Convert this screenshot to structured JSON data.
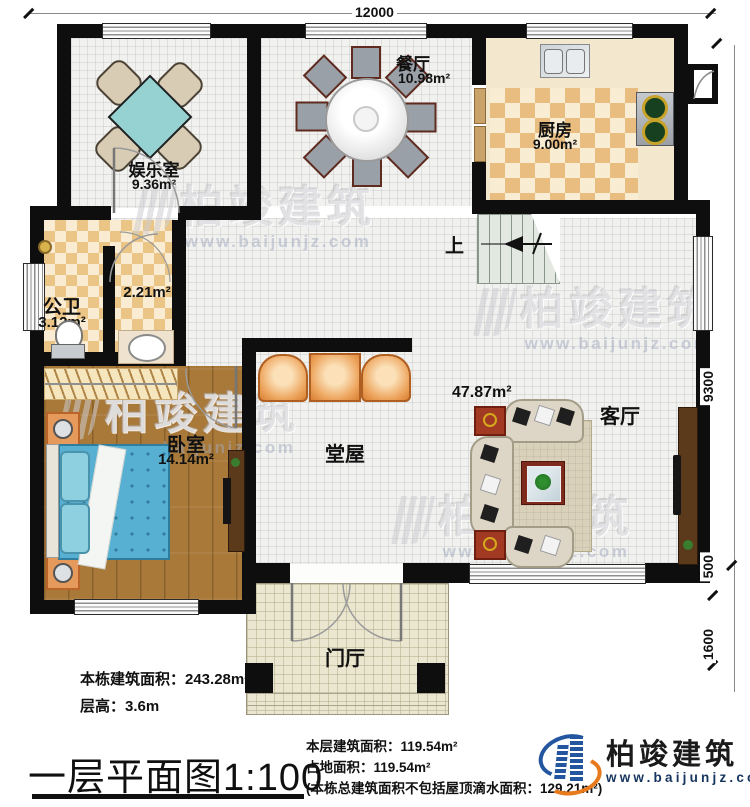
{
  "dimensions": {
    "top": "12000",
    "right_upper": "9300",
    "right_mid": "500",
    "right_lower": "1600"
  },
  "rooms": {
    "entertainment": {
      "name": "娱乐室",
      "area": "9.36m²"
    },
    "dining": {
      "name": "餐厅",
      "area": "10.98m²"
    },
    "kitchen": {
      "name": "厨房",
      "area": "9.00m²"
    },
    "bathroom": {
      "name": "公卫",
      "area": "3.12m²"
    },
    "washroom": {
      "area": "2.21m²"
    },
    "bedroom": {
      "name": "卧室",
      "area": "14.14m²"
    },
    "hall": {
      "name": "堂屋"
    },
    "living": {
      "name": "客厅",
      "area": "47.87m²"
    },
    "foyer": {
      "name": "门厅"
    },
    "stairs": {
      "up_label": "上"
    }
  },
  "footer": {
    "building_area": "本栋建筑面积：243.28m²",
    "floor_height": "层高：3.6m",
    "plan_title": "一层平面图1:100",
    "floor_area": "本层建筑面积：119.54m²",
    "land_area": "占地面积：119.54m²",
    "total_note": "(本栋总建筑面积不包括屋顶滴水面积：129.21m²)"
  },
  "logo": {
    "name": "柏竣建筑",
    "website": "www.baijunjz.com"
  },
  "watermark": {
    "text": "柏竣建筑",
    "website": "www.baijunjz.com"
  },
  "colors": {
    "wall": "#0e0e0e",
    "kitchen_checker": "#e9bd80",
    "bath_checker": "#eac585",
    "wood_floor": "#a87938",
    "bed_blue": "#57b0d2",
    "sofa_beige": "#ddd6c6",
    "accent_orange": "#eda55e",
    "logo_blue": "#2456a0",
    "logo_orange": "#e87a1e"
  }
}
